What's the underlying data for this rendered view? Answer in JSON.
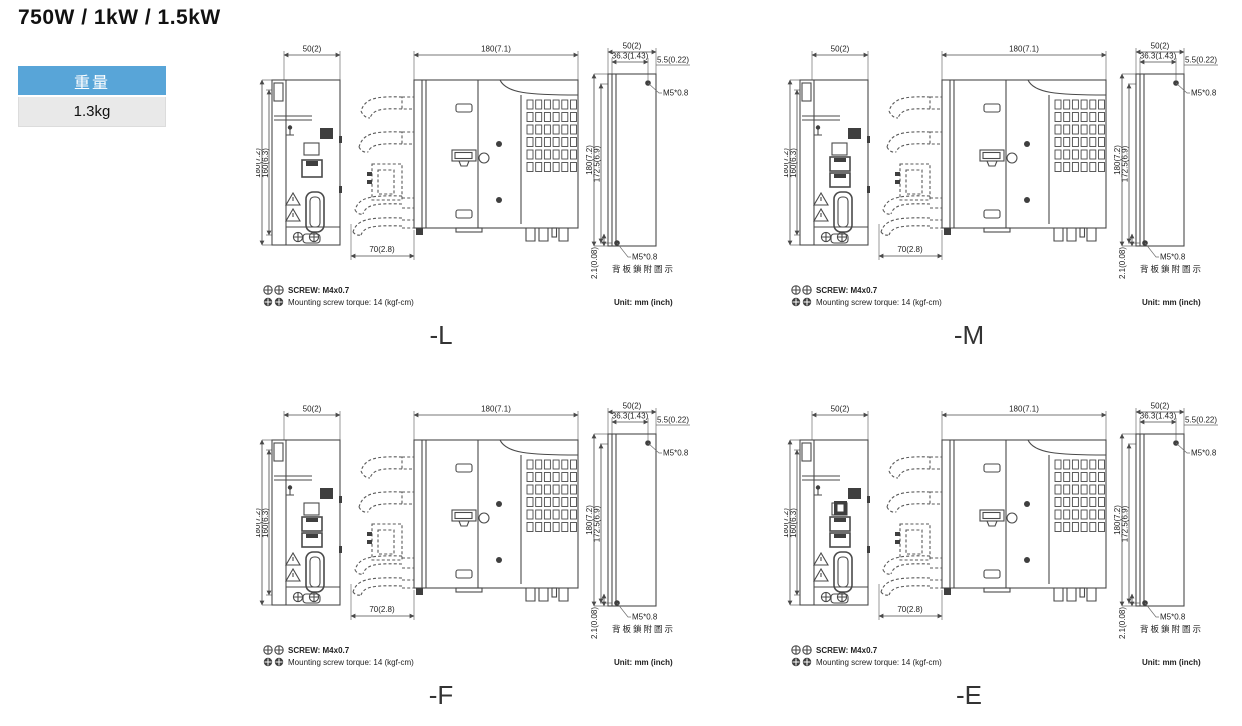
{
  "header": {
    "title": "750W / 1kW / 1.5kW",
    "weight": {
      "label": "重量",
      "value": "1.3kg"
    }
  },
  "dims": {
    "front_width": "50(2)",
    "front_height": "180(7.2)",
    "front_mount_height": "160(6.3)",
    "side_depth": "180(7.1)",
    "front_protrude": "70(2.8)",
    "back_width": "50(2)",
    "back_hole_x": "36.3(1.43)",
    "back_hole_edge": "5.5(0.22)",
    "back_height": "180(7.2)",
    "back_hole_span": "172.5(6.9)",
    "back_hole_bottom": "2.1(0.08)",
    "screw_spec": "M5*0.8",
    "back_note": "背板鎖附圖示"
  },
  "notes": {
    "screw": "SCREW: M4x0.7",
    "torque": "Mounting screw torque: 14 (kgf-cm)",
    "unit": "Unit: mm (inch)"
  },
  "variants": [
    {
      "label": "-L",
      "ports": "single"
    },
    {
      "label": "-M",
      "ports": "dual"
    },
    {
      "label": "-F",
      "ports": "dual"
    },
    {
      "label": "-E",
      "ports": "dual-extra"
    }
  ]
}
